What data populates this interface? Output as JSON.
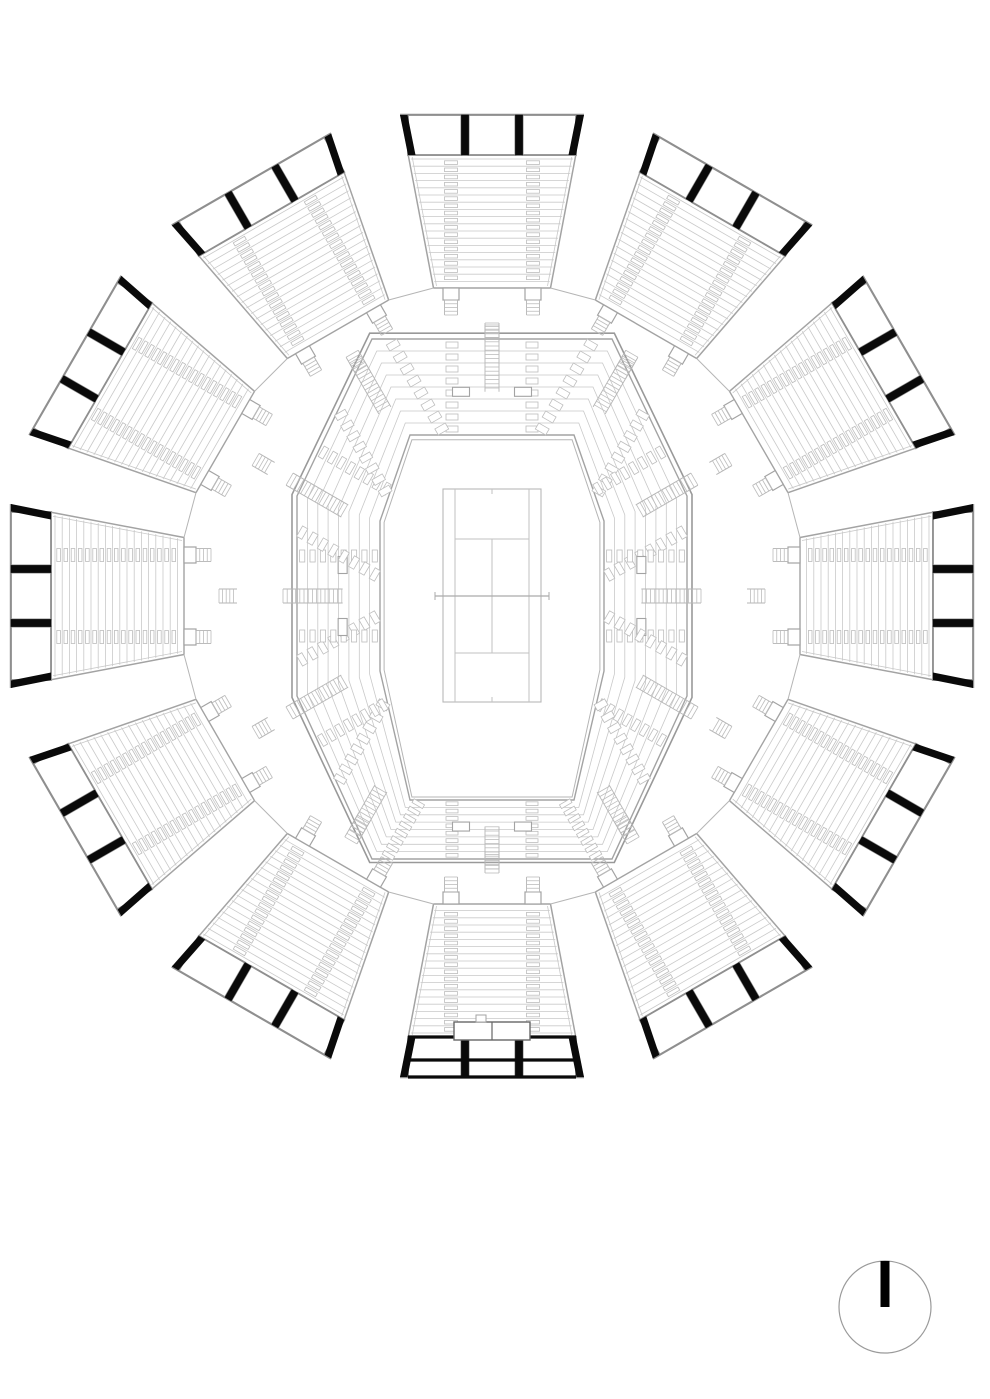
{
  "document": {
    "kind": "architectural-plan",
    "subject": "radial stadium seating plan with central tennis court",
    "background": "#ffffff"
  },
  "palette": {
    "hairline": "#c9c9c9",
    "tick": "#bdbdbd",
    "light": "#b5b5b5",
    "mid": "#a3a3a3",
    "strong": "#8f8f8f",
    "wall": "#999999",
    "court": "#c2c2c2",
    "court_edge": "#b8b8b8",
    "black": "#0a0a0a"
  },
  "stadium": {
    "center_x": 492,
    "center_y": 596,
    "section_count": 12,
    "section_angle_step_deg": 30,
    "entrance_section_index": 6,
    "wedge": {
      "outer_radius": 481,
      "band_inner_radius": 441,
      "band_half_width": 84,
      "band_outer_half_width": 92,
      "panel_boundaries": [
        -84,
        -27,
        27,
        84
      ],
      "column_half_width": 3.6,
      "row_count": 18,
      "row_start_radius": 437,
      "row_spacing": 7.2,
      "half_width_per_radius": 0.19,
      "inner_edge_radius": 308,
      "inner_half_width": 58.5,
      "aisle_offsets": [
        -41,
        41
      ],
      "aisle_half_width": 6.5,
      "tick_height": 3.6,
      "vomitory_half_width": 8,
      "vomitory_depth": 12,
      "vomitory_stair_end_radius": 281,
      "vomitory_tread_spacing": 3.75,
      "concourse_stair_start_radius": 273,
      "concourse_stair_end_radius": 255,
      "concourse_stair_half_width": 7,
      "concourse_tread_spacing": 3.6
    },
    "entrance": {
      "vestibule_half_width": 38,
      "vestibule_outer_radius": 444,
      "vestibule_inner_radius": 426,
      "band_mid_line_radius": 464,
      "notch": [
        6,
        16,
        426,
        419
      ]
    }
  },
  "bowl": {
    "inner_octagon": [
      [
        -82,
        -161
      ],
      [
        82,
        -161
      ],
      [
        112,
        -75
      ],
      [
        112,
        75
      ],
      [
        82,
        204
      ],
      [
        -82,
        204
      ],
      [
        -112,
        75
      ],
      [
        -112,
        -75
      ]
    ],
    "outer_octagon": [
      [
        -120,
        -257
      ],
      [
        120,
        -257
      ],
      [
        195,
        -100
      ],
      [
        195,
        100
      ],
      [
        120,
        263
      ],
      [
        -120,
        263
      ],
      [
        -195,
        100
      ],
      [
        -195,
        -100
      ]
    ],
    "row_ring_count": 7,
    "front_apron_t": -0.05,
    "back_wall_t": 1.06,
    "stair_half_width": 7,
    "stair_tread_spacing": 4.2,
    "stair_back_overhang": 14,
    "stair_penetration": 0.55,
    "tick_offsets": [
      -40,
      40
    ],
    "tick_half_width": 6,
    "platform_angles_deg": [
      0,
      90,
      180,
      270
    ],
    "platform_offsets": [
      -31,
      31
    ],
    "platform_t": 0.45,
    "platform_width": 17,
    "platform_height": 9
  },
  "court": {
    "half_width": 49,
    "top_offset": 107,
    "bottom_offset": 106,
    "singles_offset": 37,
    "service_line_offset": 57,
    "net_half_width": 57,
    "net_post_tick": 4,
    "center_mark_length": 5
  },
  "north_arrow": {
    "cx": 885,
    "cy": 1307,
    "radius": 46,
    "bar_width": 9,
    "bar_color": "#000000",
    "ring_color": "#9a9a9a"
  }
}
